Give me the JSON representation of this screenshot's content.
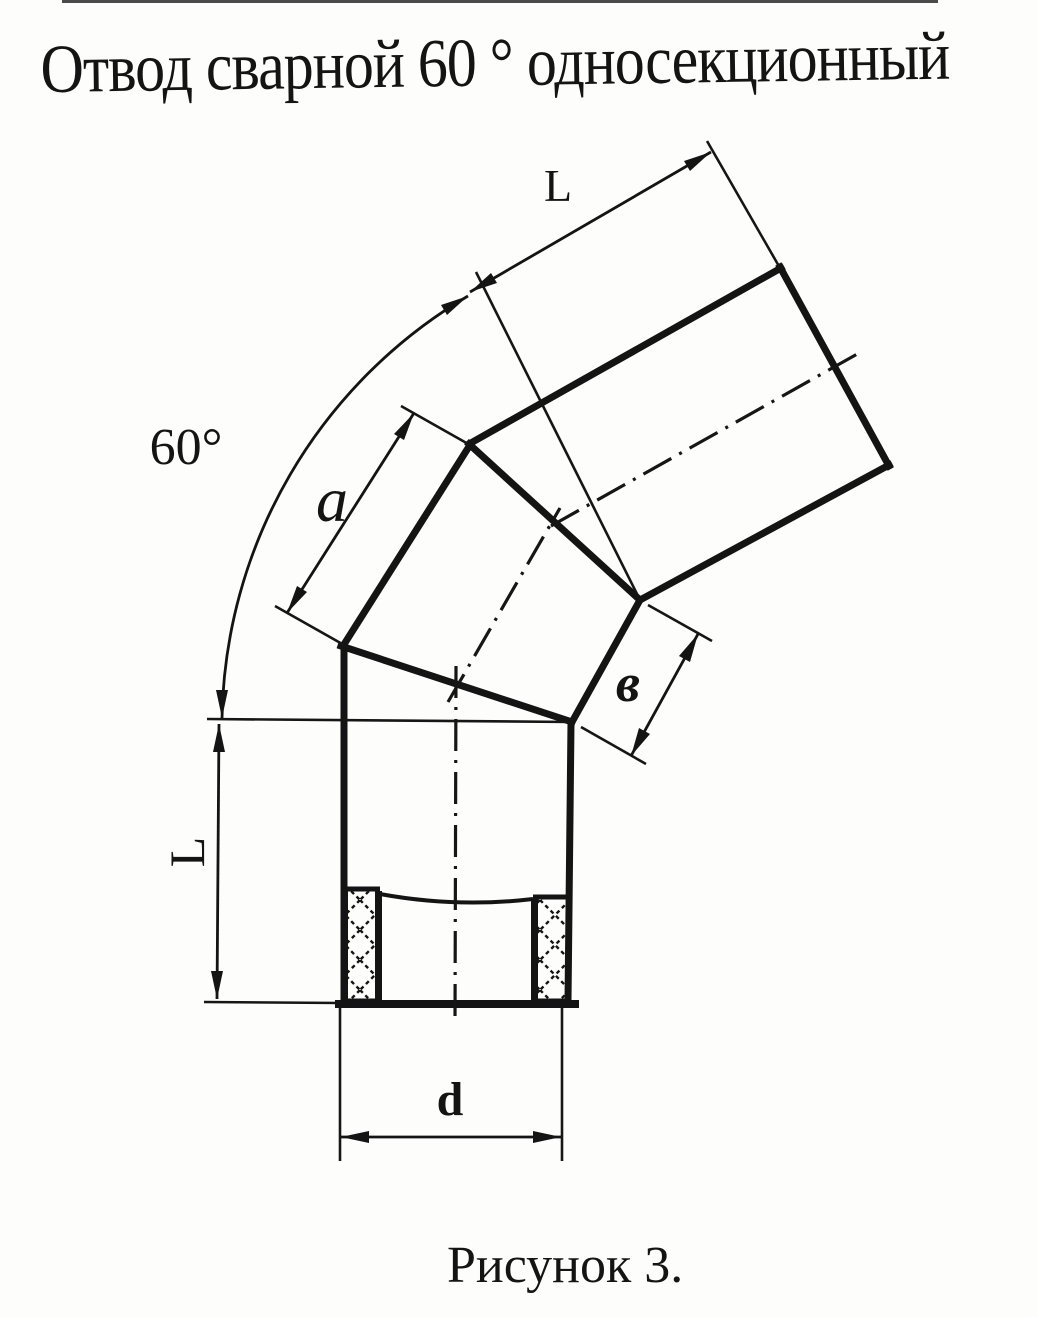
{
  "page": {
    "background": "#fdfdfb",
    "ink": "#141414"
  },
  "title": "Отвод сварной 60 ° односекционный",
  "figure": {
    "caption": "Рисунок 3.",
    "description": "welded-60-degree-single-section-elbow-drawing",
    "labels": {
      "length_top": "L",
      "angle": "60°",
      "segment_outer": "a",
      "segment_inner": "в",
      "length_left": "L",
      "diameter": "d"
    }
  }
}
